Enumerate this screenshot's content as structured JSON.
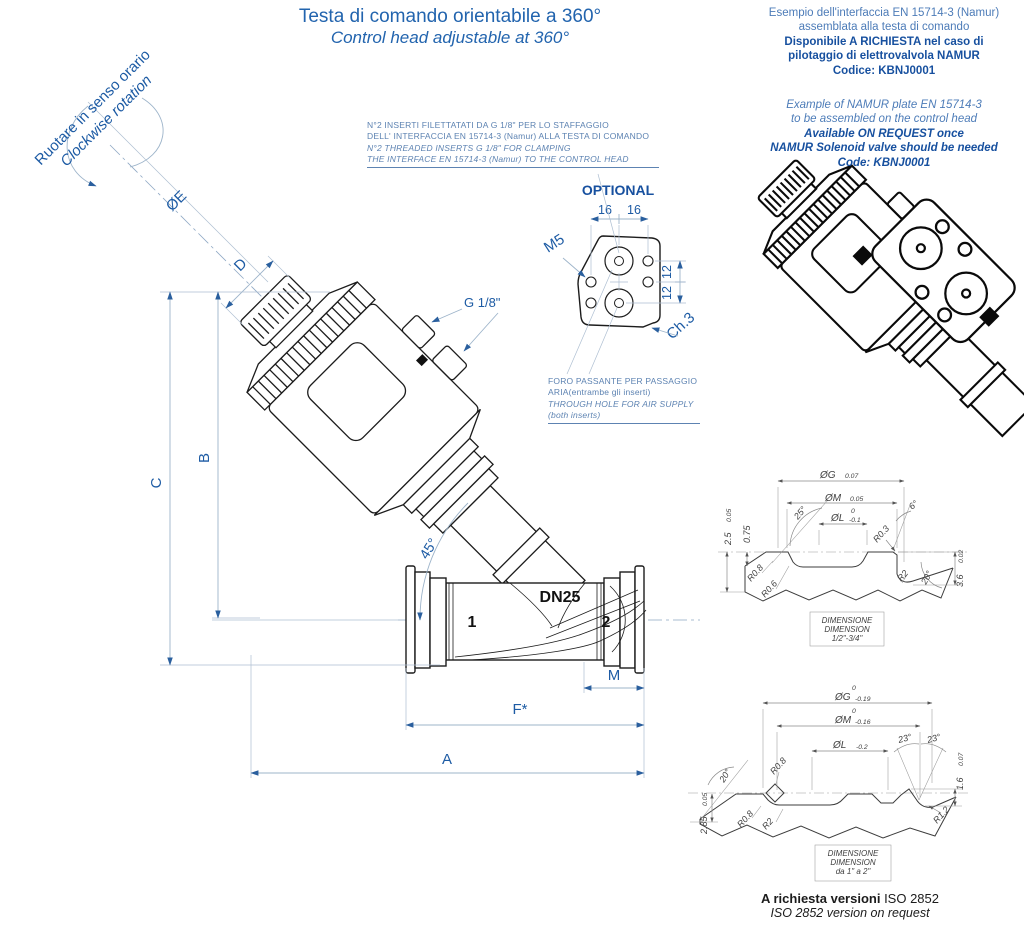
{
  "title": {
    "it": "Testa di comando orientabile a 360°",
    "en": "Control head adjustable at 360°"
  },
  "namur_note_it": {
    "l1": "Esempio dell'interfaccia EN 15714-3 (Namur)",
    "l2": "assemblata alla testa di comando",
    "l3": "Disponibile A RICHIESTA nel caso di",
    "l4": "pilotaggio di elettrovalvola NAMUR",
    "l5": "Codice: KBNJ0001"
  },
  "namur_note_en": {
    "l1": "Example of NAMUR plate EN 15714-3",
    "l2": "to be assembled on the control head",
    "l3": "Available ON REQUEST once",
    "l4": "NAMUR Solenoid valve should be needed",
    "l5": "Code: KBNJ0001"
  },
  "rotation_note": {
    "it": "Ruotare in senso orario",
    "en": "Clockwise rotation"
  },
  "inserts_note": {
    "l1": "N°2 INSERTI FILETTATATI DA G 1/8\"  PER LO STAFFAGGIO",
    "l2": "DELL' INTERFACCIA EN 15714-3 (Namur)  ALLA TESTA DI COMANDO",
    "l3": "N°2 THREADED INSERTS G 1/8\" FOR CLAMPING",
    "l4": "THE INTERFACE EN 15714-3 (Namur) TO THE CONTROL HEAD"
  },
  "air_note": {
    "l1": "FORO PASSANTE PER PASSAGGIO",
    "l2": "ARIA(entrambe gli inserti)",
    "l3": "THROUGH HOLE FOR AIR SUPPLY",
    "l4": "(both inserts)"
  },
  "optional_detail": {
    "label": "OPTIONAL",
    "dim_16a": "16",
    "dim_16b": "16",
    "dim_12a": "12",
    "dim_12b": "12",
    "thread": "M5",
    "chamfer": "Ch.3"
  },
  "main_dims": {
    "a": "A",
    "b": "B",
    "c": "C",
    "d": "D",
    "e": "ØE",
    "f": "F*",
    "m": "M",
    "angle": "45°",
    "port_thread": "G 1/8\"",
    "dn": "DN25",
    "port1": "1",
    "port2": "2"
  },
  "detail_small": {
    "box_l1": "DIMENSIONE",
    "box_l2": "DIMENSION",
    "box_l3": "1/2\"-3/4\"",
    "dg": "ØG",
    "dg_tol": "0.07",
    "dm": "ØM",
    "dm_tol": "0.05",
    "dl": "ØL",
    "dl_sup": "0",
    "dl_tol": "-0.1",
    "h1": "2.5",
    "h1_tol": "0.05",
    "h2": "0.75",
    "ang1": "25°",
    "ang2": "6°",
    "ang3": "20°",
    "r1": "R0.3",
    "r2": "R0.8",
    "r3": "R0.6",
    "r4": "R2",
    "h3": "3.6",
    "h3_tol": "0.02"
  },
  "detail_large": {
    "box_l1": "DIMENSIONE",
    "box_l2": "DIMENSION",
    "box_l3": "da 1\" a 2\"",
    "dg": "ØG",
    "dg_sup": "0",
    "dg_tol": "-0.19",
    "dm": "ØM",
    "dm_sup": "0",
    "dm_tol": "-0.16",
    "dl": "ØL",
    "dl_tol": "-0.2",
    "ang1": "23°",
    "ang2": "23°",
    "ang3": "20°",
    "h1": "1.6",
    "h1_tol": "0.07",
    "h2": "2.85",
    "h2_tol": "0.05",
    "r1": "R0.8",
    "r2": "R0.8",
    "r3": "R2",
    "r4": "R1.2"
  },
  "footer": {
    "it_bold": "A richiesta versioni",
    "it_rest": " ISO 2852",
    "en": "ISO 2852 version on request"
  }
}
